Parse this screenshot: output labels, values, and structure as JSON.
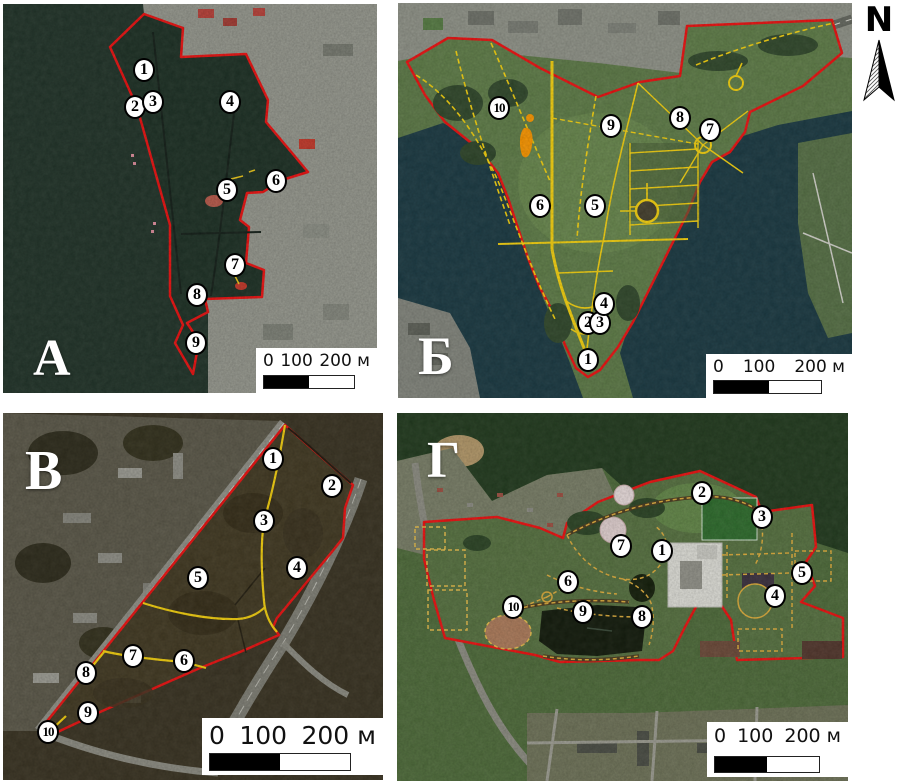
{
  "figure": {
    "description_visible_text_only": true,
    "boundary_color": "#e81212",
    "path_color": "#f0cd10",
    "marker_fill": "#ffffff",
    "marker_text_color": "#000000"
  },
  "north": {
    "label": "N"
  },
  "scalebar": {
    "labels": [
      "0",
      "100",
      "200 м"
    ]
  },
  "panels": [
    {
      "id": "A",
      "letter": "А",
      "markers": [
        {
          "n": "1",
          "x": 141,
          "y": 66
        },
        {
          "n": "2",
          "x": 132,
          "y": 103
        },
        {
          "n": "3",
          "x": 150,
          "y": 98
        },
        {
          "n": "4",
          "x": 227,
          "y": 98
        },
        {
          "n": "5",
          "x": 224,
          "y": 186
        },
        {
          "n": "6",
          "x": 273,
          "y": 177
        },
        {
          "n": "7",
          "x": 232,
          "y": 261
        },
        {
          "n": "8",
          "x": 194,
          "y": 291
        },
        {
          "n": "9",
          "x": 193,
          "y": 339
        }
      ]
    },
    {
      "id": "B",
      "letter": "Б",
      "markers": [
        {
          "n": "1",
          "x": 190,
          "y": 357
        },
        {
          "n": "2",
          "x": 190,
          "y": 320
        },
        {
          "n": "3",
          "x": 202,
          "y": 320
        },
        {
          "n": "4",
          "x": 206,
          "y": 301
        },
        {
          "n": "5",
          "x": 197,
          "y": 203
        },
        {
          "n": "6",
          "x": 142,
          "y": 203
        },
        {
          "n": "7",
          "x": 312,
          "y": 127
        },
        {
          "n": "8",
          "x": 282,
          "y": 115
        },
        {
          "n": "9",
          "x": 213,
          "y": 123
        },
        {
          "n": "10",
          "x": 101,
          "y": 105
        }
      ]
    },
    {
      "id": "V",
      "letter": "В",
      "markers": [
        {
          "n": "1",
          "x": 270,
          "y": 46
        },
        {
          "n": "2",
          "x": 329,
          "y": 73
        },
        {
          "n": "3",
          "x": 261,
          "y": 108
        },
        {
          "n": "4",
          "x": 294,
          "y": 155
        },
        {
          "n": "5",
          "x": 195,
          "y": 165
        },
        {
          "n": "6",
          "x": 181,
          "y": 248
        },
        {
          "n": "7",
          "x": 130,
          "y": 243
        },
        {
          "n": "8",
          "x": 83,
          "y": 260
        },
        {
          "n": "9",
          "x": 85,
          "y": 300
        },
        {
          "n": "10",
          "x": 45,
          "y": 319
        }
      ]
    },
    {
      "id": "G",
      "letter": "Г",
      "markers": [
        {
          "n": "1",
          "x": 265,
          "y": 138
        },
        {
          "n": "2",
          "x": 305,
          "y": 80
        },
        {
          "n": "3",
          "x": 365,
          "y": 104
        },
        {
          "n": "4",
          "x": 378,
          "y": 183
        },
        {
          "n": "5",
          "x": 405,
          "y": 160
        },
        {
          "n": "6",
          "x": 171,
          "y": 169
        },
        {
          "n": "7",
          "x": 224,
          "y": 133
        },
        {
          "n": "8",
          "x": 245,
          "y": 204
        },
        {
          "n": "9",
          "x": 186,
          "y": 199
        },
        {
          "n": "10",
          "x": 116,
          "y": 194
        }
      ]
    }
  ]
}
